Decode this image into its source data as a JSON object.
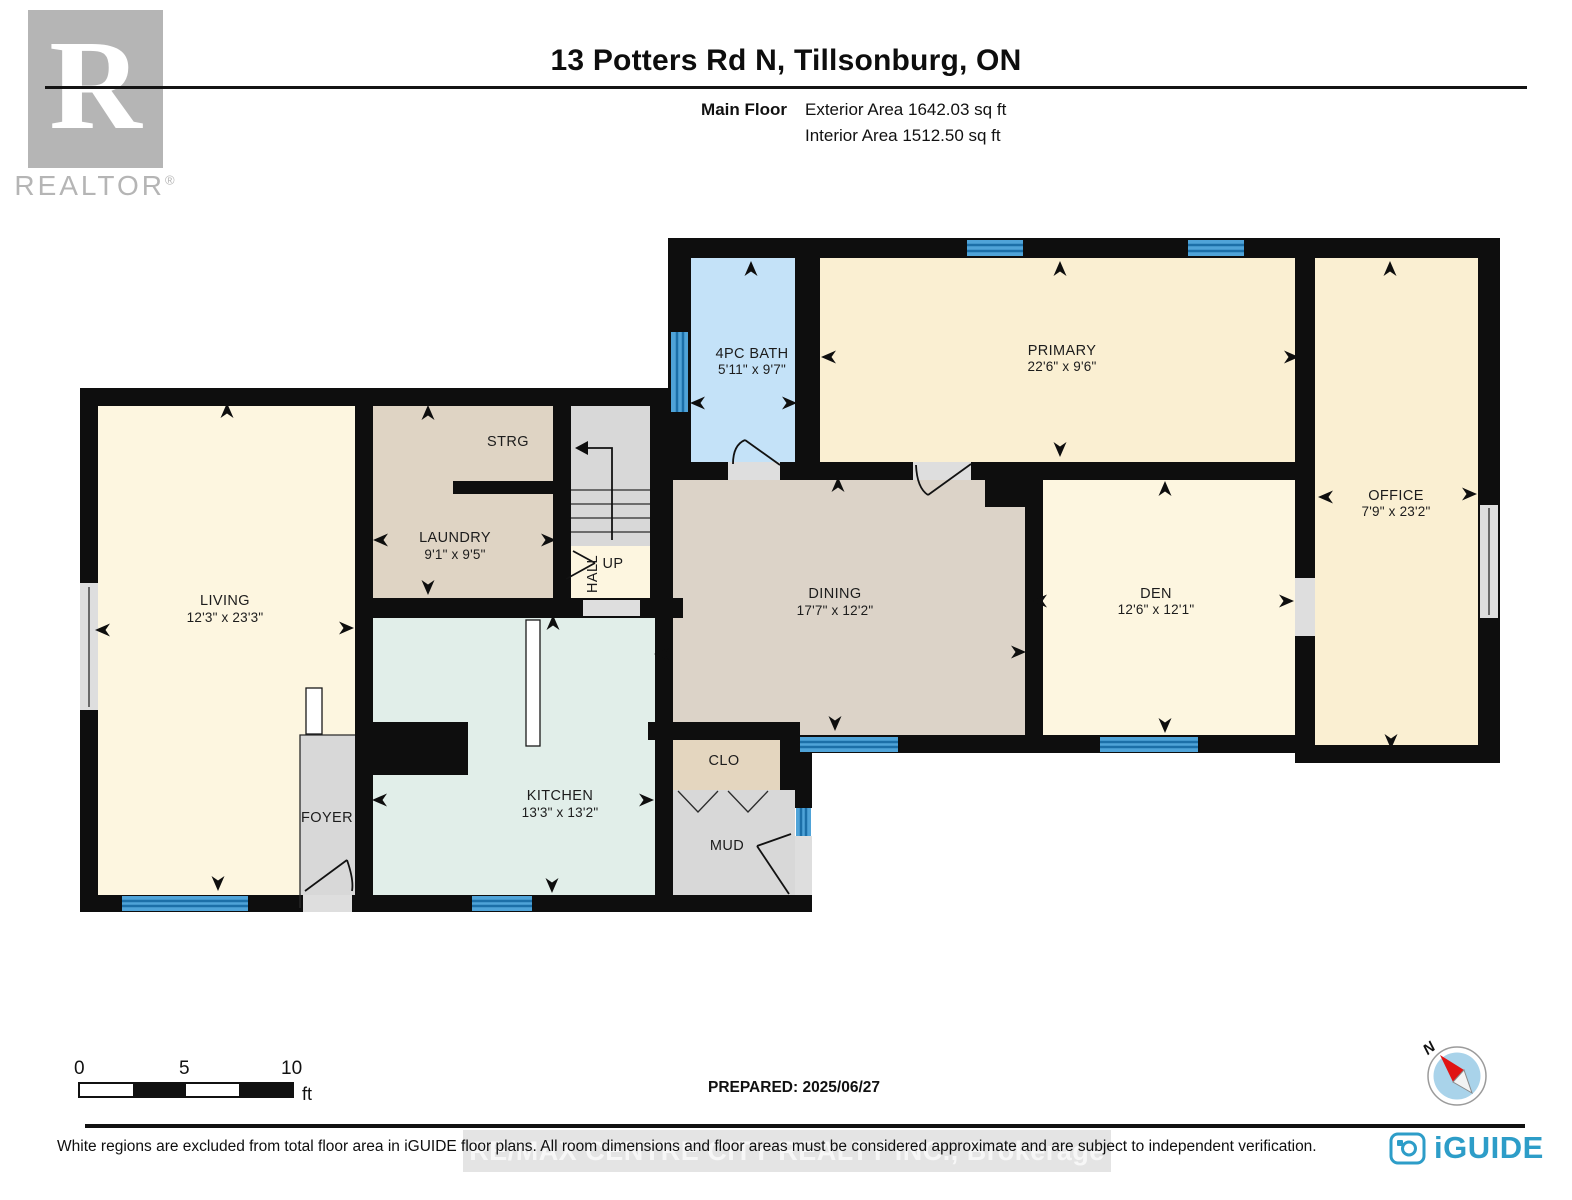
{
  "header": {
    "title": "13 Potters Rd N, Tillsonburg, ON",
    "floor_label": "Main Floor",
    "exterior_area": "Exterior Area 1642.03 sq ft",
    "interior_area": "Interior Area 1512.50 sq ft",
    "realtor_r": "R",
    "realtor_wordmark": "REALTOR",
    "realtor_reg": "®"
  },
  "rooms": {
    "bath": {
      "label": "4PC BATH",
      "dims": "5'11\" x 9'7\""
    },
    "primary": {
      "label": "PRIMARY",
      "dims": "22'6\" x 9'6\""
    },
    "office": {
      "label": "OFFICE",
      "dims": "7'9\" x 23'2\""
    },
    "den": {
      "label": "DEN",
      "dims": "12'6\" x 12'1\""
    },
    "dining": {
      "label": "DINING",
      "dims": "17'7\" x 12'2\""
    },
    "living": {
      "label": "LIVING",
      "dims": "12'3\" x 23'3\""
    },
    "laundry": {
      "label": "LAUNDRY",
      "dims": "9'1\" x 9'5\""
    },
    "strg": {
      "label": "STRG"
    },
    "hall": {
      "label": "HALL"
    },
    "up": {
      "label": "UP"
    },
    "kitchen": {
      "label": "KITCHEN",
      "dims": "13'3\" x 13'2\""
    },
    "foyer": {
      "label": "FOYER"
    },
    "clo": {
      "label": "CLO"
    },
    "mud": {
      "label": "MUD"
    }
  },
  "scale_bar": {
    "start": "0",
    "mid": "5",
    "end": "10",
    "unit": "ft"
  },
  "compass": {
    "north_label": "N"
  },
  "footer": {
    "prepared": "PREPARED: 2025/06/27",
    "disclaimer": "White regions are excluded from total floor area in iGUIDE floor plans. All room dimensions and floor areas must be considered approximate and are subject to independent verification.",
    "watermark": "RE/MAX CENTRE CITY REALTY INC., Brokerage",
    "brand": "iGUIDE"
  },
  "colors": {
    "wall": "#0e0e0e",
    "window_blue": "#4fa3d8",
    "window_stripe": "#1c6fa8",
    "room_cream": "#faefd2",
    "room_cream_light": "#fdf6e0",
    "room_blue": "#c4e2f8",
    "room_tan": "#dfd4c4",
    "room_dining": "#dcd3c8",
    "room_mint": "#e1eee9",
    "room_clo": "#e4d6bf",
    "room_gray": "#d8d8d8",
    "opening_gray": "#dedede",
    "brand_blue": "#2d9dc8",
    "logo_gray": "#b5b5b5"
  }
}
